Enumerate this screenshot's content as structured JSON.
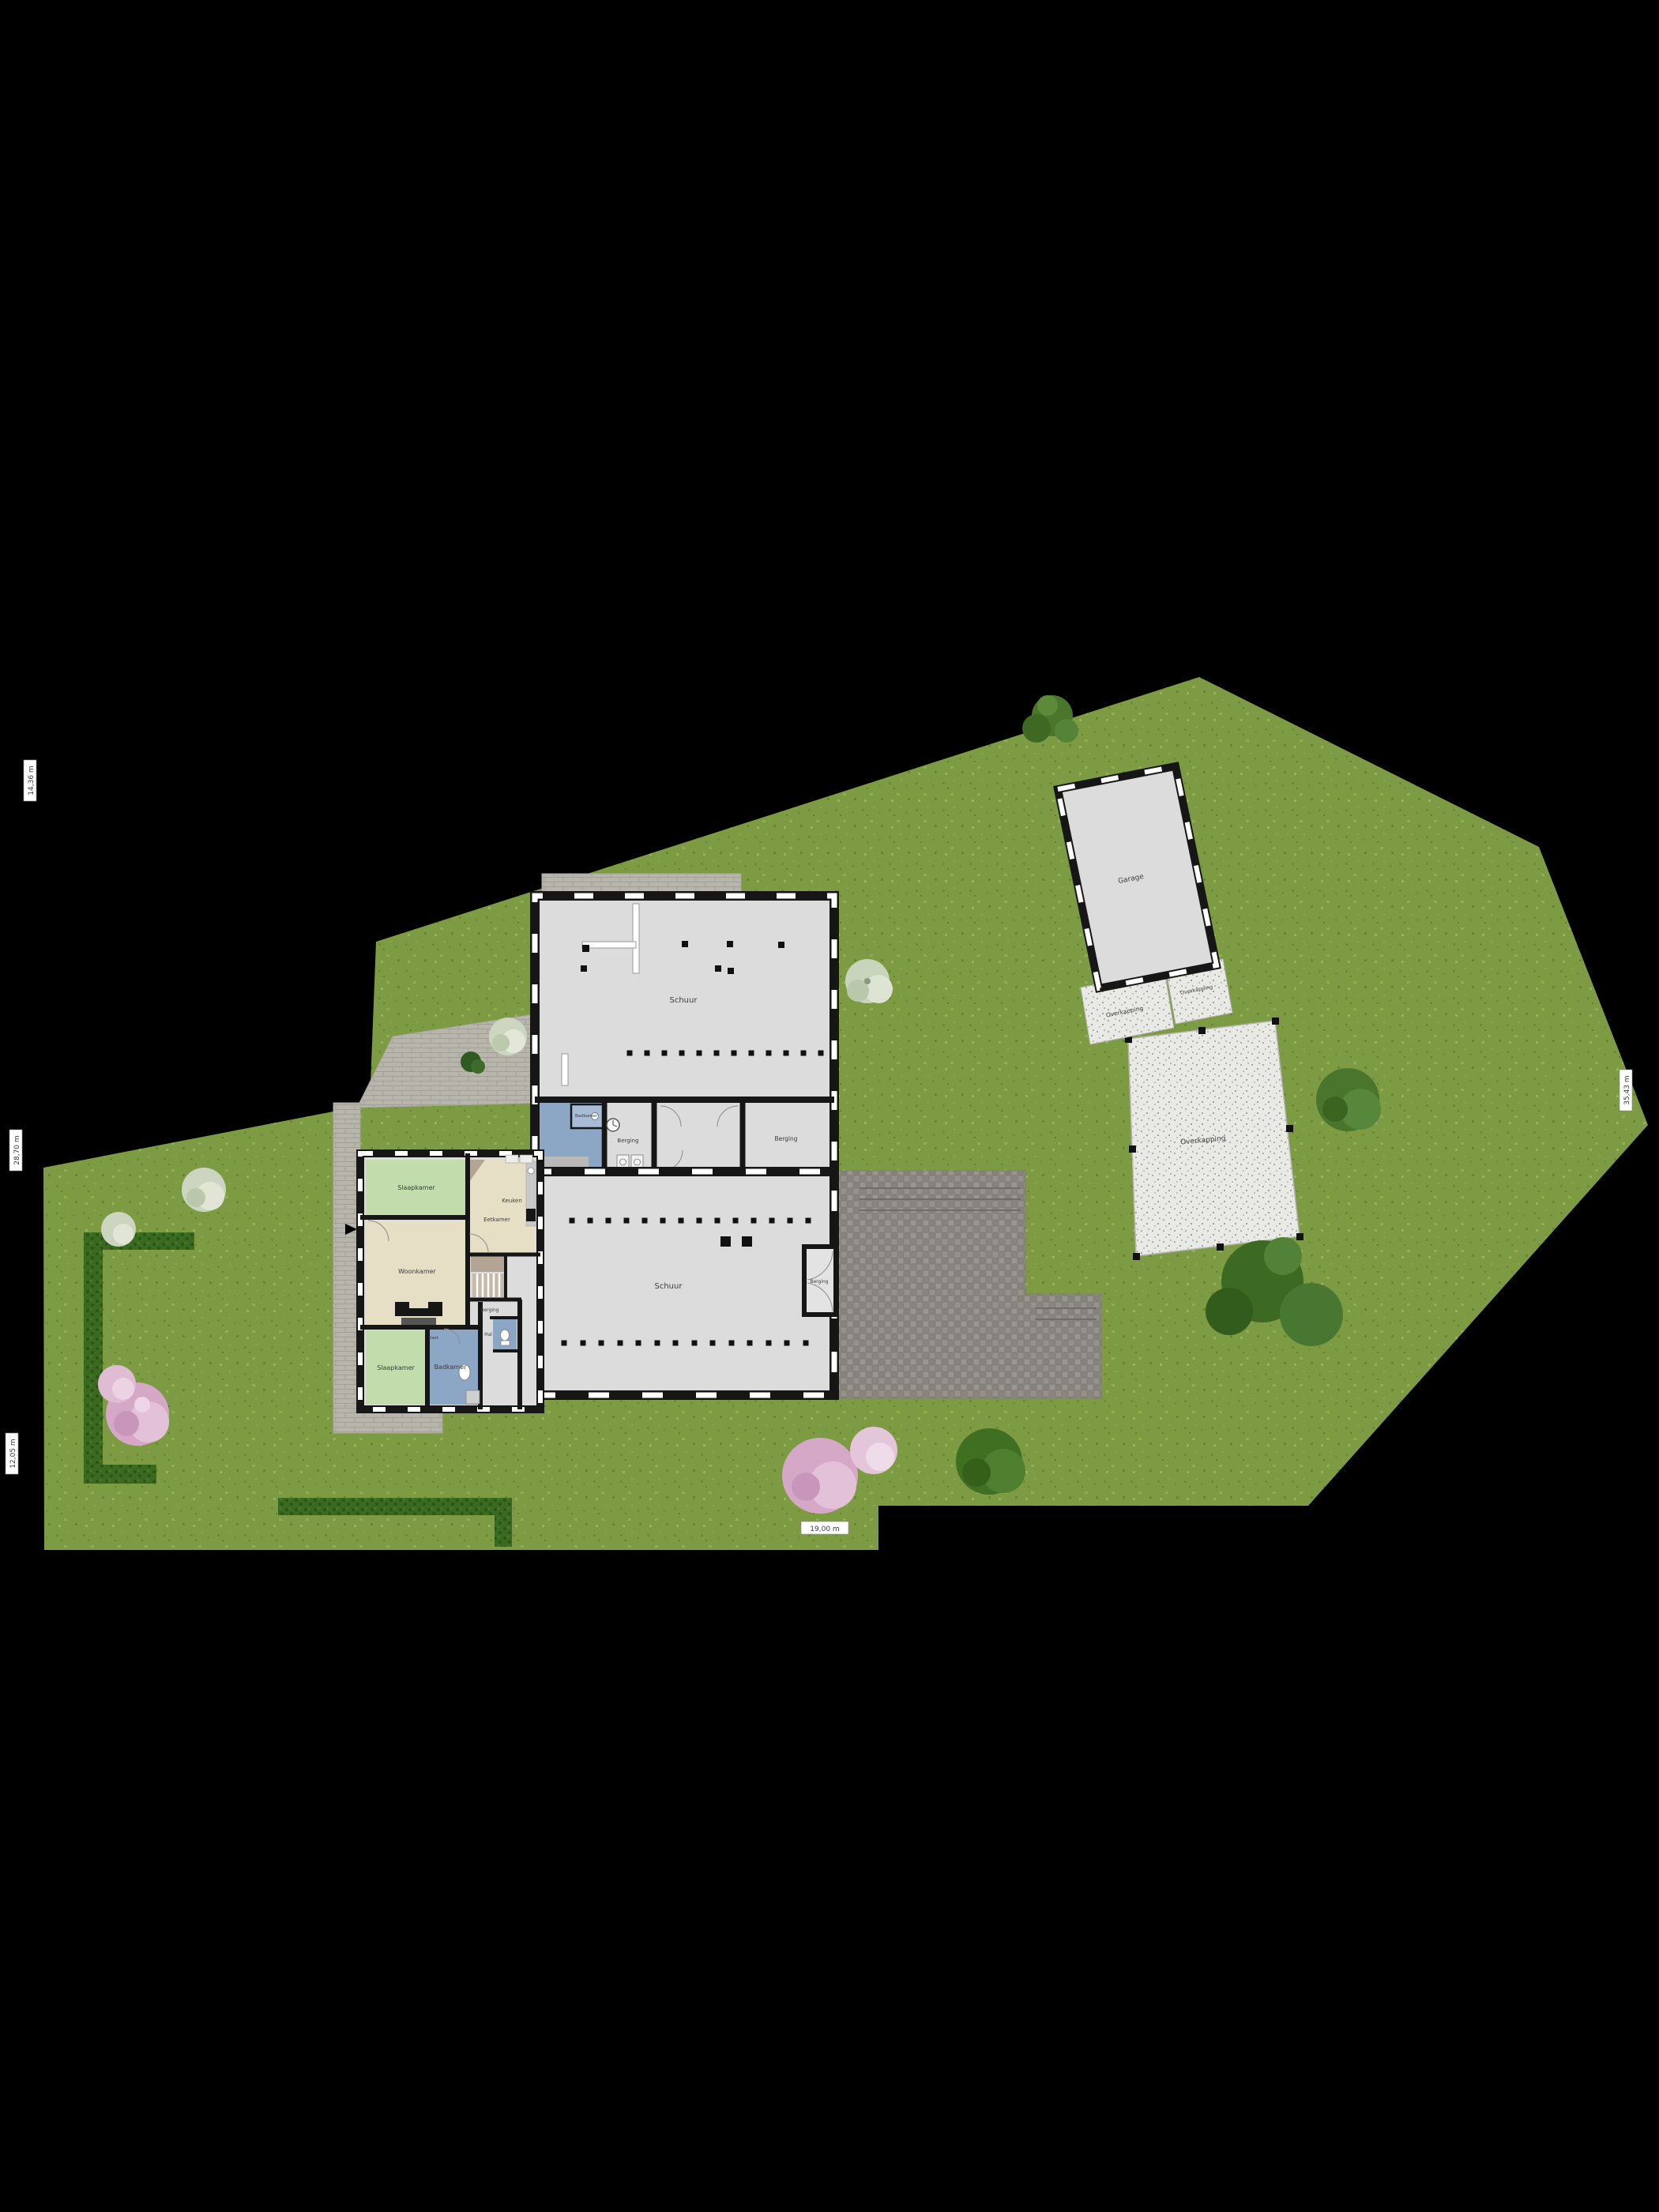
{
  "plan": {
    "buildings": {
      "top_barn_label": "Schuur",
      "lower_barn_label": "Schuur",
      "garage_label": "Garage",
      "canopy_label": "Overkapping",
      "patio_left_label": "Overkapping",
      "patio_right_label": "Overkapping",
      "vestibule_label": "Berging"
    },
    "barn_rooms": {
      "bathroom_label": "Badkamer",
      "storage_left_label": "Berging",
      "storage_right_label": "Berging"
    },
    "house_rooms": {
      "bedroom_top_label": "Slaapkamer",
      "kitchen_label": "Keuken",
      "dining_label": "Eetkamer",
      "living_label": "Woonkamer",
      "bedroom_bottom_label": "Slaapkamer",
      "bathroom_label": "Badkamer",
      "storage_label": "Berging",
      "hall_label": "Hal",
      "closet_label": "Kast"
    },
    "dimensions": {
      "left_top": "14,36 m",
      "left_middle": "28,70 m",
      "left_bottom": "12,05 m",
      "right_side": "35,43 m",
      "bottom": "19,00 m"
    },
    "colors": {
      "background": "#000000",
      "grass": "#7d9b42",
      "hedge": "#39691f",
      "floor": "#dcdcdc",
      "wall": "#161616",
      "room_green": "#c3dcab",
      "room_beige": "#e6dfc6",
      "room_blue": "#8ca6c6",
      "paving": "#b8b5ad",
      "driveway": "#908d87",
      "gravel": "#e9e9e6",
      "tree_green": "#4a762b",
      "tree_blossom": "#d6a8c8"
    }
  }
}
